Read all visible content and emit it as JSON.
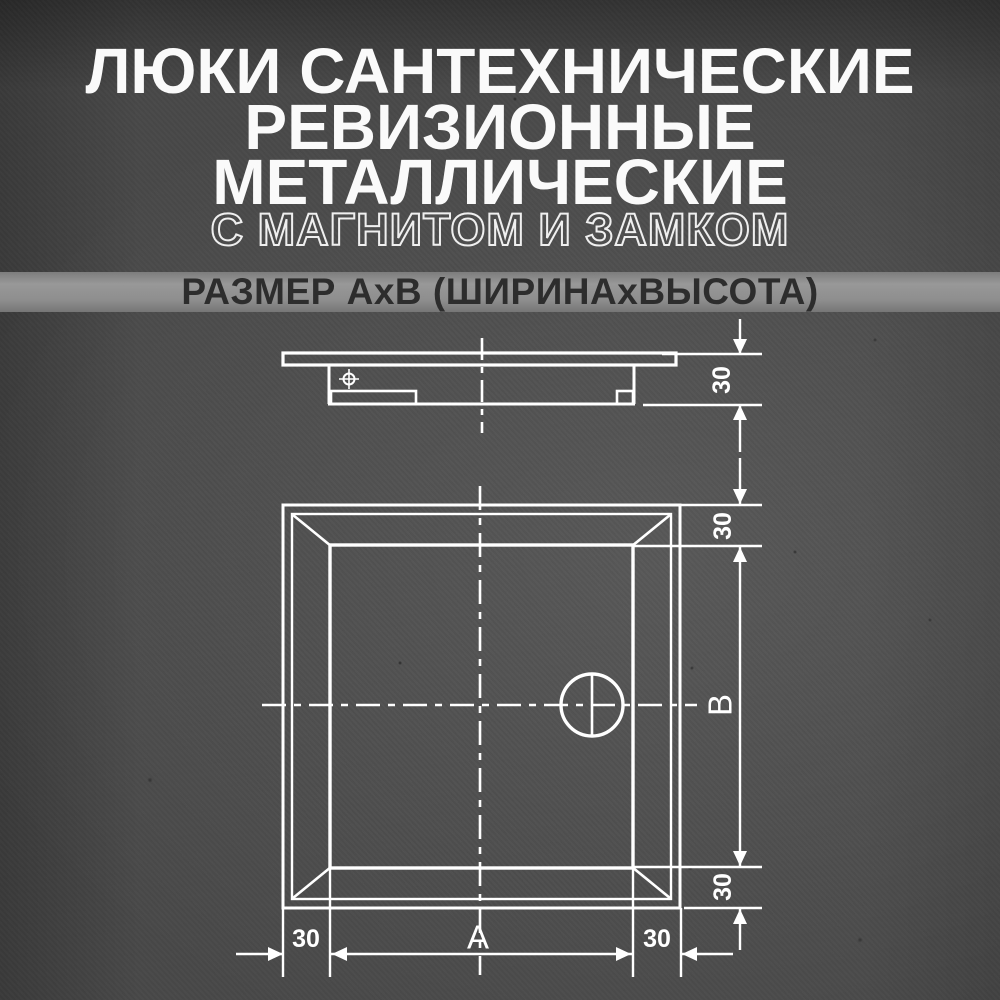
{
  "header": {
    "title_line1": "ЛЮКИ САНТЕХНИЧЕСКИЕ",
    "title_line2": "РЕВИЗИОННЫЕ",
    "title_line3": "МЕТАЛЛИЧЕСКИЕ",
    "subtitle": "С МАГНИТОМ И ЗАМКОМ",
    "size_note": "РАЗМЕР АхВ (ШИРИНАхВЫСОТА)"
  },
  "drawing": {
    "side_view": {
      "depth_label": "30"
    },
    "front_view": {
      "top_offset_label": "30",
      "height_label": "В",
      "bottom_offset_label": "30",
      "left_offset_label": "30",
      "width_label": "А",
      "right_offset_label": "30"
    }
  },
  "colors": {
    "background": "#484848",
    "line": "#ffffff",
    "band_background": "#8f8f8f",
    "band_text": "#2d2d2d",
    "title_text": "#fafafa"
  }
}
